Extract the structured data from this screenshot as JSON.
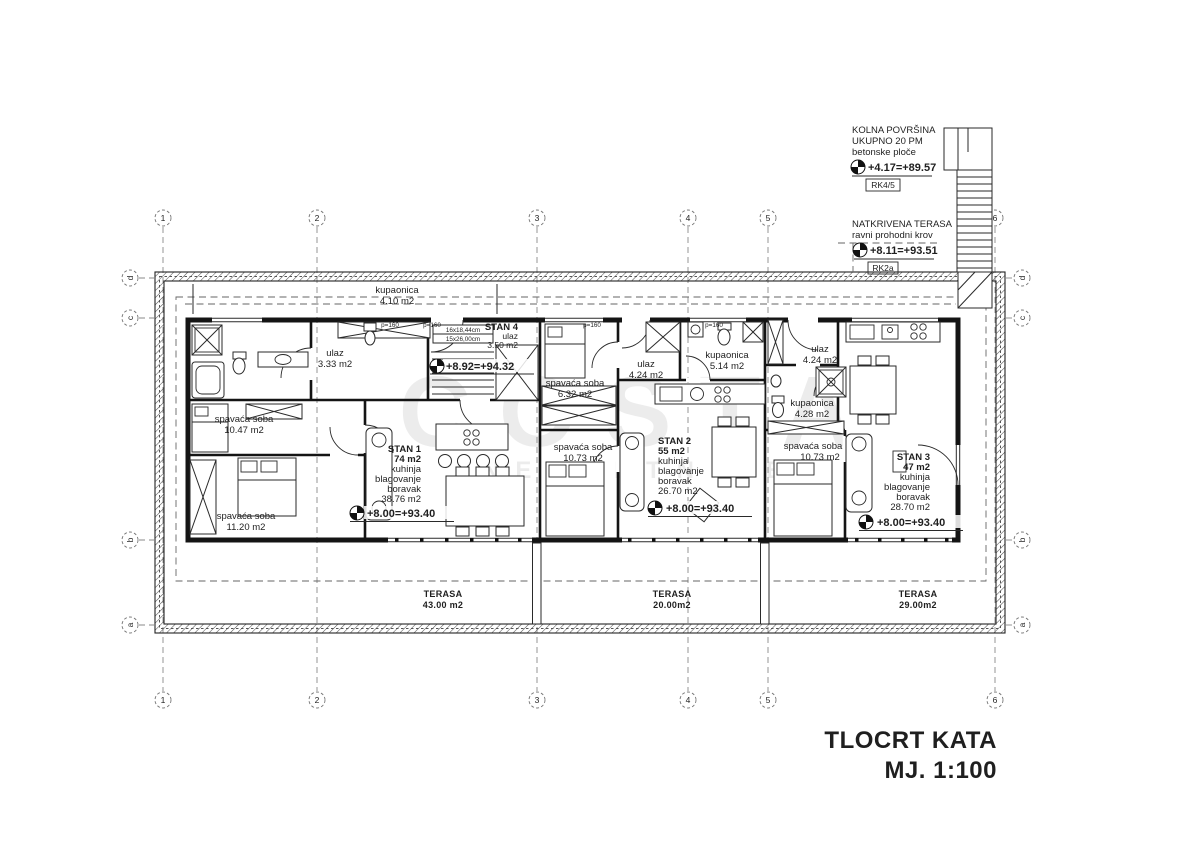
{
  "colors": {
    "ink": "#1a1a1a",
    "grid_line": "#8a8a8a",
    "watermark_gray": "#dcdcdc"
  },
  "watermark": {
    "line1": "COSTA",
    "line2": "NEKRETNINE"
  },
  "title_block": {
    "line1": "TLOCRT KATA",
    "line2": "MJ. 1:100"
  },
  "grid": {
    "cols": [
      "1",
      "2",
      "3",
      "4",
      "5",
      "6"
    ],
    "rows": [
      "d",
      "c",
      "b",
      "a"
    ]
  },
  "annotations": {
    "kolna": {
      "line1": "KOLNA POVRŠINA",
      "line2": "UKUPNO 20 PM",
      "line3": "betonske ploče",
      "elevation": "+4.17=+89.57",
      "tag": "RK4/5"
    },
    "natkrivena": {
      "line1": "NATKRIVENA TERASA",
      "line2": "ravni prohodni krov",
      "elevation": "+8.11=+93.51",
      "tag": "RK2a"
    }
  },
  "labels": {
    "p160": "p=160"
  },
  "stairs": {
    "dim1": "16x18,44cm",
    "dim2": "15x26,00cm"
  },
  "rooms": {
    "kupaonica_top": {
      "name": "kupaonica",
      "area": "4.10 m2"
    },
    "ulaz_s1": {
      "name": "ulaz",
      "area": "3.33 m2"
    },
    "spavaca_s1_a": {
      "name": "spavaća soba",
      "area": "10.47 m2"
    },
    "spavaca_s1_b": {
      "name": "spavaća soba",
      "area": "11.20 m2"
    },
    "spavaca_s2_a": {
      "name": "spavaća soba",
      "area": "6.32 m2"
    },
    "spavaca_s2_b": {
      "name": "spavaća soba",
      "area": "10.73 m2"
    },
    "ulaz_s2": {
      "name": "ulaz",
      "area": "4.24 m2"
    },
    "kupaonica_s2": {
      "name": "kupaonica",
      "area": "5.14 m2"
    },
    "ulaz_s3": {
      "name": "ulaz",
      "area": "4.24 m2"
    },
    "kupaonica_s3": {
      "name": "kupaonica",
      "area": "4.28 m2"
    },
    "spavaca_s3": {
      "name": "spavaća soba",
      "area": "10.73 m2"
    }
  },
  "stan1": {
    "name": "STAN 1",
    "area": "74 m2",
    "l1": "kuhinja",
    "l2": "blagovanje",
    "l3": "boravak",
    "l4": "38.76 m2",
    "elevation": "+8.00=+93.40"
  },
  "stan2": {
    "name": "STAN 2",
    "area": "55 m2",
    "l1": "kuhinja",
    "l2": "blagovanje",
    "l3": "boravak",
    "l4": "26.70 m2",
    "elevation": "+8.00=+93.40"
  },
  "stan3": {
    "name": "STAN 3",
    "area": "47 m2",
    "l1": "kuhinja",
    "l2": "blagovanje",
    "l3": "boravak",
    "l4": "28.70 m2",
    "elevation": "+8.00=+93.40"
  },
  "stan4": {
    "name": "STAN 4",
    "sub": "ulaz",
    "area": "3.50 m2",
    "elevation": "+8.92=+94.32"
  },
  "terraces": [
    {
      "name": "TERASA",
      "area": "43.00 m2"
    },
    {
      "name": "TERASA",
      "area": "20.00m2"
    },
    {
      "name": "TERASA",
      "area": "29.00m2"
    }
  ]
}
